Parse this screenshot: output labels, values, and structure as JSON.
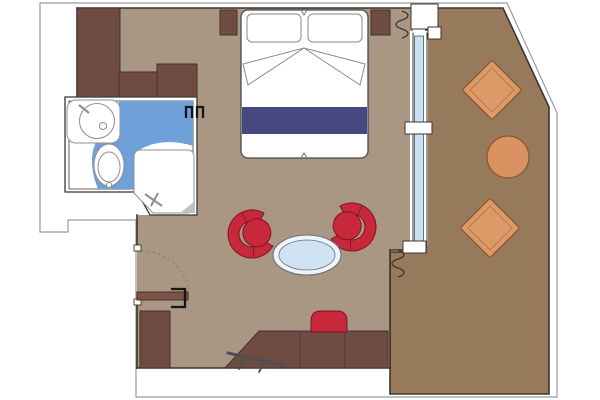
{
  "title": "Suite floor plan",
  "palette": {
    "background": "#FFFFFF",
    "hull_outline": "#9B9B9B",
    "wall": "#3D352E",
    "cabin_floor": "#A99784",
    "balcony_floor": "#97795C",
    "wood_furniture": "#6F4B41",
    "entry_door": "#7B5349",
    "accent_red": "#C8293A",
    "accent_red_edge": "#7E1420",
    "bed_runner": "#474880",
    "bathroom_floor": "#6FA0D9",
    "window_glass": "#C8E0F2",
    "table_glass": "#CFE3F4",
    "lounge_orange": "#DB9A67",
    "lounge_orange_edge": "#8A572E",
    "balcony_table_orange": "#DA9263",
    "fixture_line": "#8F8F8F",
    "shower_corner_gray": "#C2C1C0",
    "luggage_rack_gray": "#4F4F52",
    "handle_black": "#161616"
  },
  "plan": {
    "rooms": [
      "cabin",
      "bathroom",
      "balcony"
    ],
    "furniture": [
      "wardrobe-units",
      "nightstands",
      "twin-beds-with-runner",
      "tub-chairs",
      "oval-coffee-table",
      "desk",
      "desk-chair",
      "luggage-rack",
      "cabinet",
      "entry-door",
      "sink-counter",
      "toilet",
      "shower",
      "balcony-lounge-chairs",
      "balcony-round-table"
    ]
  }
}
